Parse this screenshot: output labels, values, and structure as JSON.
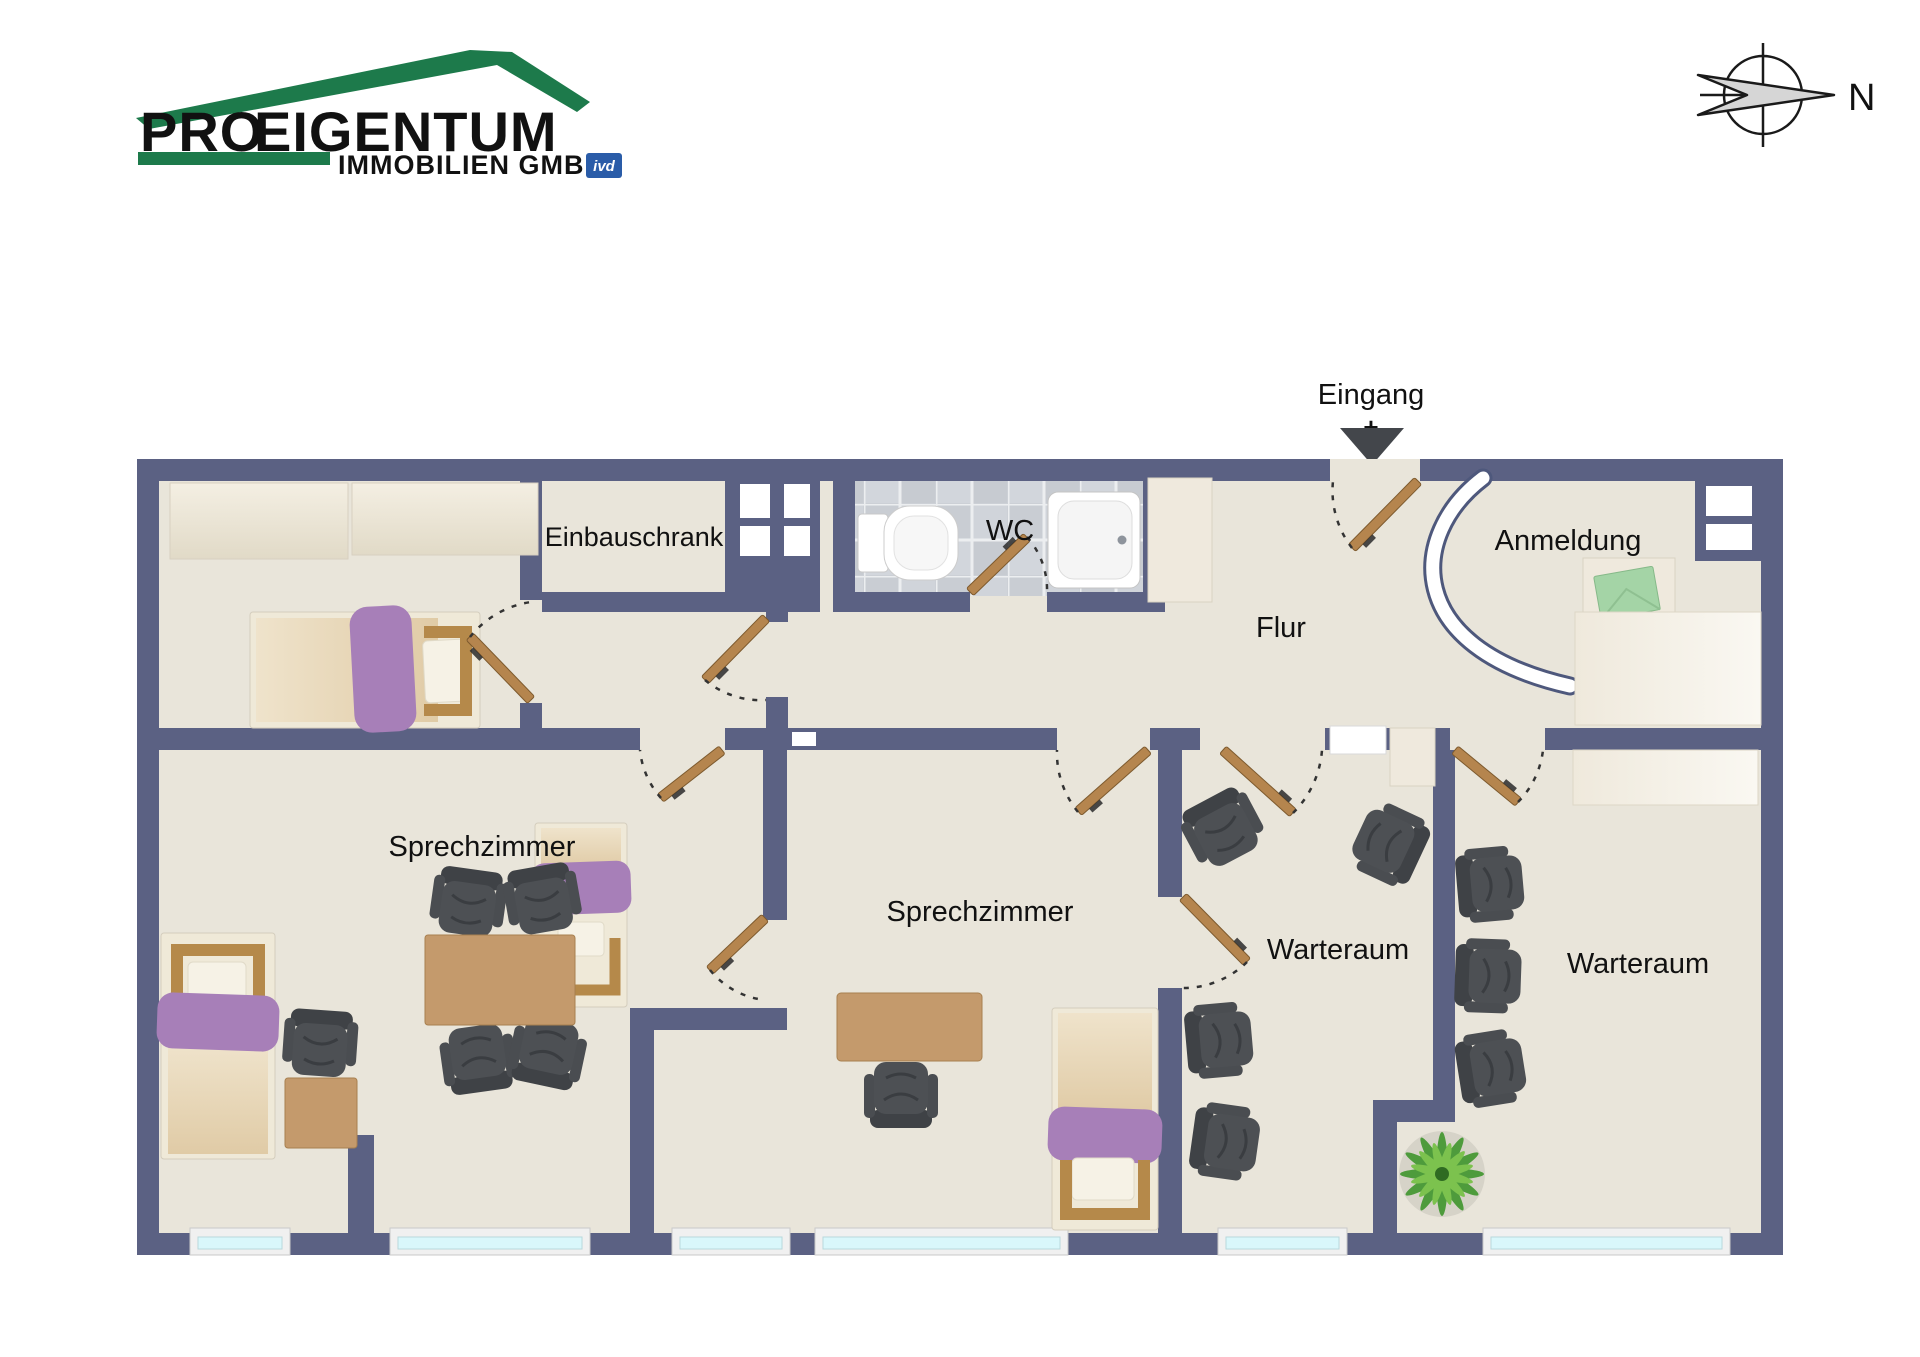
{
  "header": {
    "logo": {
      "pro": "PRO",
      "eigentum": "EIGENTUM",
      "subtitle": "IMMOBILIEN GMBH",
      "badge": "ivd"
    },
    "compass": {
      "north": "N"
    }
  },
  "plan": {
    "entrance": {
      "label": "Eingang",
      "plus": "+"
    },
    "labels": {
      "einbauschrank": "Einbauschrank",
      "wc": "WC",
      "flur": "Flur",
      "anmeldung": "Anmeldung",
      "sprechzimmer_left": "Sprechzimmer",
      "sprechzimmer_middle": "Sprechzimmer",
      "warteraum_left": "Warteraum",
      "warteraum_right": "Warteraum"
    },
    "colors": {
      "wall": "#5b6183",
      "floor": "#e9e5da",
      "tile": "#ccd0d6",
      "door_wood": "#b5854e",
      "window_glass": "#d9f7fb",
      "bed_accent_purple": "#a77fb8",
      "furniture_wood": "#c49a6c",
      "chair_dark": "#474a4e",
      "plant_green": "#4e9b3c",
      "logo_green": "#1d7a4b",
      "logo_dark": "#3a4046",
      "badge_blue": "#2a5ca8",
      "entrance_arrow": "#43464b"
    }
  }
}
